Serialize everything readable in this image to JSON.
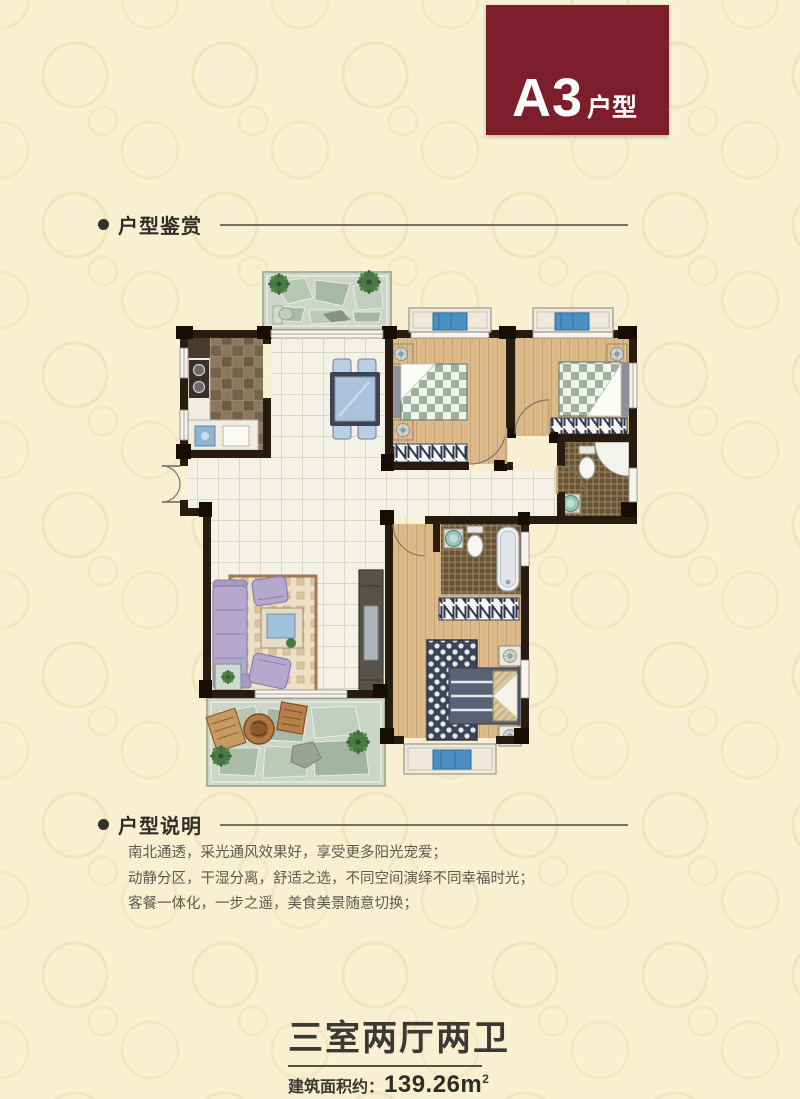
{
  "badge": {
    "code": "A3",
    "suffix": "户型",
    "bg_color": "#7c1e2c",
    "text_color": "#ffffff"
  },
  "sections": {
    "appreciation": {
      "title": "户型鉴赏"
    },
    "description": {
      "title": "户型说明",
      "lines": [
        "南北通透，采光通风效果好，享受更多阳光宠爱；",
        "动静分区，干湿分离，舒适之选，不同空间演绎不同幸福时光；",
        "客餐一体化，一步之遥，美食美景随意切换；"
      ]
    }
  },
  "footer": {
    "title": "三室两厅两卫",
    "area_label": "建筑面积约：",
    "area_value": "139.26m",
    "area_sup": "2"
  },
  "floorplan": {
    "depicts": [
      "top-balcony",
      "kitchen",
      "dining-area",
      "bedroom-1",
      "bedroom-2",
      "bathroom-1",
      "living-room",
      "master-bathroom",
      "master-bedroom",
      "bottom-balcony"
    ],
    "colors": {
      "page_bg": "#f8f0d0",
      "pattern": "#dcc887",
      "wall": "#281c10",
      "wood_floor": "#ddba8a",
      "tile_floor": "#f4f1e6",
      "stone_floor": "#ccd5c7",
      "bed_blanket": "#9fb09e",
      "window_cushion": "#4a90c4",
      "sofa": "#b4a8cd",
      "master_bed": "#5a6174"
    }
  }
}
